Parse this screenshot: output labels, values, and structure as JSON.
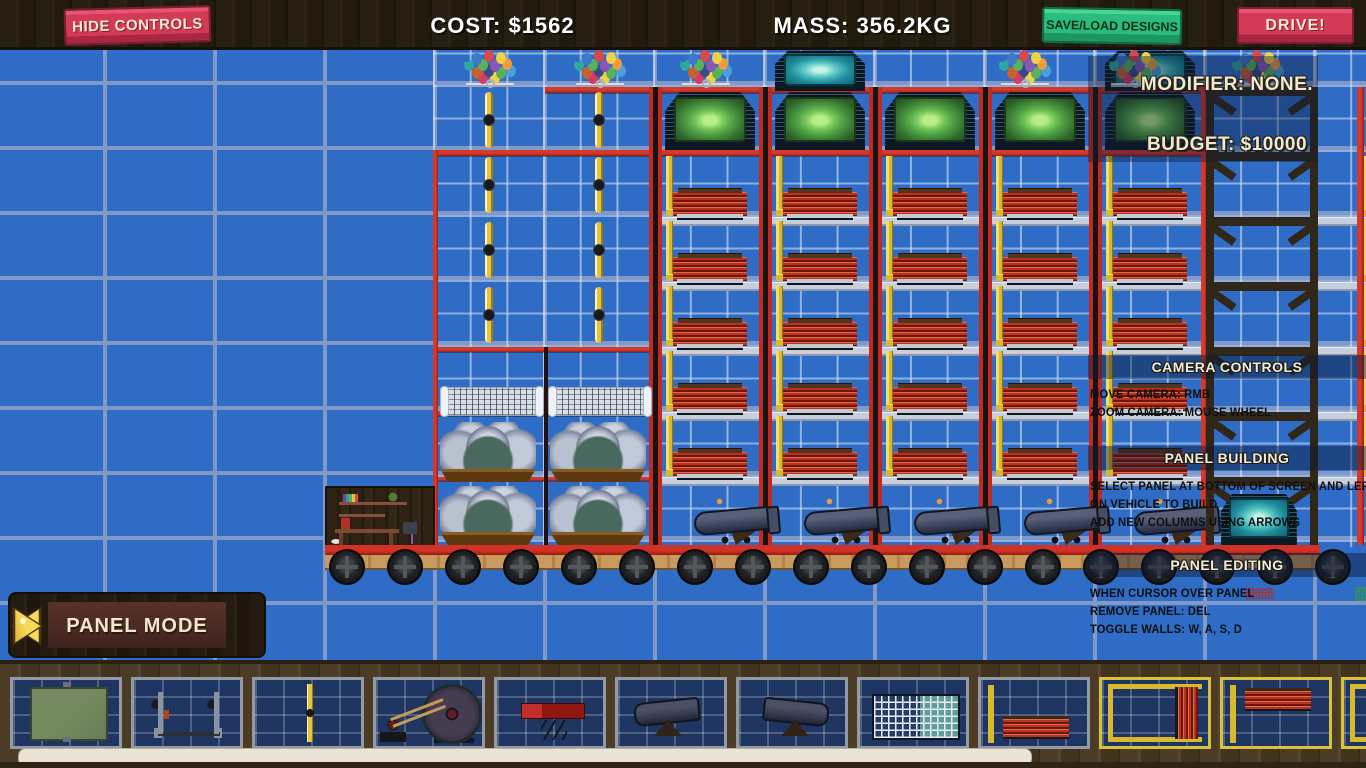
{
  "top_bar": {
    "hide_controls_label": "HIDE CONTROLS",
    "cost_label": "COST: $1562",
    "mass_label": "MASS: 356.2KG",
    "save_load_label": "SAVE/LOAD DESIGNS",
    "drive_label": "DRIVE!"
  },
  "hud": {
    "modifier": "MODIFIER: NONE.",
    "budget": "BUDGET: $10000",
    "camera_controls": {
      "title": "CAMERA CONTROLS",
      "lines": [
        "MOVE CAMERA: RMB",
        "ZOOM CAMERA: MOUSE WHEEL"
      ]
    },
    "panel_building": {
      "title": "PANEL BUILDING",
      "lines": [
        "SELECT PANEL AT BOTTOM OF SCREEN AND LEFT CLICK",
        "ON VEHICLE TO BUILD",
        "ADD NEW COLUMNS USING ARROWS"
      ]
    },
    "panel_editing": {
      "title": "PANEL EDITING",
      "lines": [
        "WHEN CURSOR OVER PANEL",
        "REMOVE PANEL: DEL",
        "TOGGLE WALLS: W, A, S, D"
      ]
    }
  },
  "mode_selector": {
    "label": "PANEL MODE"
  },
  "palette": {
    "items": [
      {
        "id": "green-screen-panel",
        "cls": "it-screen",
        "selected": false
      },
      {
        "id": "tow-hitch",
        "cls": "it-hitch",
        "selected": false
      },
      {
        "id": "propeller",
        "cls": "it-prop",
        "selected": false
      },
      {
        "id": "motor-flywheel",
        "cls": "it-motor",
        "selected": false
      },
      {
        "id": "spring-platform",
        "cls": "it-spring",
        "selected": false
      },
      {
        "id": "cannon-right",
        "cls": "it-cannon",
        "selected": false
      },
      {
        "id": "cannon-left",
        "cls": "it-cannon it-flip",
        "selected": false
      },
      {
        "id": "grid-panel",
        "cls": "it-grid",
        "selected": false
      },
      {
        "id": "radiator-floor",
        "cls": "it-radb",
        "selected": false
      },
      {
        "id": "radiator-right-wall",
        "cls": "it-radr",
        "selected": true
      },
      {
        "id": "radiator-ceiling",
        "cls": "it-radt",
        "selected": true
      },
      {
        "id": "radiator-wall-partial",
        "cls": "it-radr",
        "selected": true
      }
    ]
  },
  "colors": {
    "background_blue": "#2e6cc6",
    "grid_line": "#8099c7",
    "frame_red": "#c5281e",
    "wall_yellow": "#d8b92e",
    "button_red": "#d23a58",
    "button_green": "#2bbd7b",
    "wood_dark": "#281f13",
    "cream_text": "#f3e8cd"
  },
  "scene": {
    "sprites": [
      [
        "finegrid",
        433,
        50,
        933,
        497
      ],
      [
        "gbeam",
        657,
        217,
        548,
        6
      ],
      [
        "gbeam",
        657,
        282,
        548,
        6
      ],
      [
        "gbeam",
        657,
        347,
        548,
        6
      ],
      [
        "gbeam",
        657,
        412,
        548,
        6
      ],
      [
        "gbeam",
        657,
        477,
        548,
        6
      ],
      [
        "gbeam",
        1318,
        217,
        48,
        6
      ],
      [
        "gbeam",
        1318,
        282,
        48,
        6
      ],
      [
        "gbeam",
        1318,
        347,
        48,
        6
      ],
      [
        "gbeam",
        1318,
        412,
        48,
        6
      ],
      [
        "gbeam",
        1318,
        477,
        48,
        6
      ],
      [
        "hline",
        545,
        87,
        660,
        6
      ],
      [
        "hline",
        433,
        150,
        772,
        6
      ],
      [
        "hline",
        433,
        347,
        224,
        5
      ],
      [
        "hline",
        433,
        411,
        224,
        5
      ],
      [
        "hline",
        433,
        477,
        224,
        4
      ],
      [
        "vline",
        433,
        150,
        5,
        400
      ],
      [
        "vline",
        1201,
        87,
        6,
        460
      ],
      [
        "vline",
        1357,
        87,
        7,
        458
      ],
      [
        "vline",
        1313,
        487,
        5,
        60
      ],
      [
        "vdark",
        544,
        347,
        4,
        198
      ],
      [
        "rpost",
        649,
        87,
        13,
        460
      ],
      [
        "rpost",
        759,
        87,
        13,
        460
      ],
      [
        "rpost",
        869,
        87,
        13,
        460
      ],
      [
        "rpost",
        979,
        87,
        13,
        460
      ],
      [
        "rpost",
        1089,
        87,
        13,
        460
      ],
      [
        "ywall",
        666,
        156,
        7,
        58
      ],
      [
        "ywall",
        666,
        221,
        7,
        58
      ],
      [
        "ywall",
        666,
        286,
        7,
        58
      ],
      [
        "ywall",
        666,
        351,
        7,
        58
      ],
      [
        "ywall",
        666,
        416,
        7,
        58
      ],
      [
        "ywall",
        776,
        156,
        7,
        58
      ],
      [
        "ywall",
        776,
        221,
        7,
        58
      ],
      [
        "ywall",
        776,
        286,
        7,
        58
      ],
      [
        "ywall",
        776,
        351,
        7,
        58
      ],
      [
        "ywall",
        776,
        416,
        7,
        58
      ],
      [
        "ywall",
        886,
        156,
        7,
        58
      ],
      [
        "ywall",
        886,
        221,
        7,
        58
      ],
      [
        "ywall",
        886,
        286,
        7,
        58
      ],
      [
        "ywall",
        886,
        351,
        7,
        58
      ],
      [
        "ywall",
        886,
        416,
        7,
        58
      ],
      [
        "ywall",
        996,
        156,
        7,
        58
      ],
      [
        "ywall",
        996,
        221,
        7,
        58
      ],
      [
        "ywall",
        996,
        286,
        7,
        58
      ],
      [
        "ywall",
        996,
        351,
        7,
        58
      ],
      [
        "ywall",
        996,
        416,
        7,
        58
      ],
      [
        "ywall",
        1106,
        156,
        7,
        58
      ],
      [
        "ywall",
        1106,
        221,
        7,
        58
      ],
      [
        "ywall",
        1106,
        286,
        7,
        58
      ],
      [
        "ywall",
        1106,
        351,
        7,
        58
      ],
      [
        "ywall",
        1106,
        416,
        7,
        58
      ],
      [
        "ywall",
        1364,
        156,
        7,
        58
      ],
      [
        "ywall",
        1364,
        221,
        7,
        58
      ],
      [
        "ywall",
        1364,
        286,
        7,
        58
      ],
      [
        "ywall",
        1364,
        351,
        7,
        58
      ],
      [
        "ywall",
        1364,
        416,
        7,
        58
      ],
      [
        "radiator",
        673,
        192,
        74,
        24
      ],
      [
        "radiator",
        673,
        257,
        74,
        24
      ],
      [
        "radiator",
        673,
        322,
        74,
        24
      ],
      [
        "radiator",
        673,
        387,
        74,
        24
      ],
      [
        "radiator",
        673,
        452,
        74,
        24
      ],
      [
        "radiator",
        783,
        192,
        74,
        24
      ],
      [
        "radiator",
        783,
        257,
        74,
        24
      ],
      [
        "radiator",
        783,
        322,
        74,
        24
      ],
      [
        "radiator",
        783,
        387,
        74,
        24
      ],
      [
        "radiator",
        783,
        452,
        74,
        24
      ],
      [
        "radiator",
        893,
        192,
        74,
        24
      ],
      [
        "radiator",
        893,
        257,
        74,
        24
      ],
      [
        "radiator",
        893,
        322,
        74,
        24
      ],
      [
        "radiator",
        893,
        387,
        74,
        24
      ],
      [
        "radiator",
        893,
        452,
        74,
        24
      ],
      [
        "radiator",
        1003,
        192,
        74,
        24
      ],
      [
        "radiator",
        1003,
        257,
        74,
        24
      ],
      [
        "radiator",
        1003,
        322,
        74,
        24
      ],
      [
        "radiator",
        1003,
        387,
        74,
        24
      ],
      [
        "radiator",
        1003,
        452,
        74,
        24
      ],
      [
        "radiator",
        1113,
        192,
        74,
        24
      ],
      [
        "radiator",
        1113,
        257,
        74,
        24
      ],
      [
        "radiator",
        1113,
        322,
        74,
        24
      ],
      [
        "radiator",
        1113,
        387,
        74,
        24
      ],
      [
        "radiator",
        1113,
        452,
        74,
        24
      ],
      [
        "gscreen",
        659,
        91,
        102,
        59
      ],
      [
        "gscreen",
        769,
        91,
        102,
        59
      ],
      [
        "gscreen",
        879,
        91,
        102,
        59
      ],
      [
        "gscreen",
        989,
        91,
        102,
        59
      ],
      [
        "gscreen",
        1099,
        91,
        102,
        59
      ],
      [
        "tscreen",
        770,
        50,
        100,
        41
      ],
      [
        "tscreen",
        1100,
        50,
        100,
        41
      ],
      [
        "prop",
        485,
        92,
        8,
        56
      ],
      [
        "prop",
        485,
        157,
        8,
        56
      ],
      [
        "prop",
        485,
        222,
        8,
        56
      ],
      [
        "prop",
        485,
        287,
        8,
        56
      ],
      [
        "prop",
        595,
        92,
        8,
        56
      ],
      [
        "prop",
        595,
        157,
        8,
        56
      ],
      [
        "prop",
        595,
        222,
        8,
        56
      ],
      [
        "prop",
        595,
        287,
        8,
        56
      ],
      [
        "net",
        441,
        387,
        100,
        27
      ],
      [
        "net",
        549,
        387,
        100,
        27
      ],
      [
        "boulders",
        436,
        422,
        104,
        60
      ],
      [
        "boulders",
        546,
        422,
        104,
        60
      ],
      [
        "boulders",
        436,
        486,
        104,
        59
      ],
      [
        "boulders",
        546,
        486,
        104,
        59
      ],
      [
        "room",
        325,
        486,
        110,
        61
      ],
      [
        "baseline",
        325,
        545,
        995,
        10
      ],
      [
        "basewood",
        325,
        555,
        995,
        13
      ],
      [
        "wheel",
        329,
        549,
        32,
        32
      ],
      [
        "wheel",
        387,
        549,
        32,
        32
      ],
      [
        "wheel",
        445,
        549,
        32,
        32
      ],
      [
        "wheel",
        503,
        549,
        32,
        32
      ],
      [
        "wheel",
        561,
        549,
        32,
        32
      ],
      [
        "wheel",
        619,
        549,
        32,
        32
      ],
      [
        "wheel",
        677,
        549,
        32,
        32
      ],
      [
        "wheel",
        735,
        549,
        32,
        32
      ],
      [
        "wheel",
        793,
        549,
        32,
        32
      ],
      [
        "wheel",
        851,
        549,
        32,
        32
      ],
      [
        "wheel",
        909,
        549,
        32,
        32
      ],
      [
        "wheel",
        967,
        549,
        32,
        32
      ],
      [
        "wheel",
        1025,
        549,
        32,
        32
      ],
      [
        "wheel",
        1083,
        549,
        32,
        32
      ],
      [
        "wheel",
        1141,
        549,
        32,
        32
      ],
      [
        "wheel",
        1199,
        549,
        32,
        32
      ],
      [
        "wheel",
        1257,
        549,
        32,
        32
      ],
      [
        "wheel",
        1315,
        549,
        32,
        32
      ],
      [
        "cannon",
        690,
        497,
        92,
        49
      ],
      [
        "cannon",
        800,
        497,
        92,
        49
      ],
      [
        "cannon",
        910,
        497,
        92,
        49
      ],
      [
        "cannon",
        1020,
        497,
        92,
        49
      ],
      [
        "cannon",
        1130,
        497,
        92,
        49
      ],
      [
        "woodcell",
        1206,
        87,
        112,
        65
      ],
      [
        "woodcell",
        1206,
        152,
        112,
        65
      ],
      [
        "woodcell",
        1206,
        217,
        112,
        65
      ],
      [
        "woodcell",
        1206,
        282,
        112,
        65
      ],
      [
        "woodcell",
        1206,
        347,
        112,
        65
      ],
      [
        "woodcell",
        1206,
        412,
        112,
        65
      ],
      [
        "woodcell",
        1206,
        477,
        112,
        68
      ],
      [
        "tscreen",
        1217,
        493,
        84,
        52
      ],
      [
        "stand",
        466,
        83,
        48,
        4
      ],
      [
        "stand",
        576,
        83,
        48,
        4
      ],
      [
        "stand",
        682,
        83,
        48,
        4
      ],
      [
        "stand",
        1001,
        83,
        48,
        4
      ],
      [
        "stand",
        1111,
        83,
        48,
        4
      ],
      [
        "stand",
        1234,
        83,
        48,
        4
      ],
      [
        "balloons",
        462,
        50,
        56,
        36
      ],
      [
        "balloons",
        572,
        50,
        56,
        36
      ],
      [
        "balloons",
        678,
        50,
        56,
        36
      ],
      [
        "balloons",
        997,
        50,
        56,
        36
      ],
      [
        "balloons",
        1107,
        50,
        56,
        36
      ],
      [
        "balloons",
        1230,
        50,
        56,
        36
      ],
      [
        "shade",
        1088,
        56,
        230,
        106
      ],
      [
        "dotsred",
        1246,
        588,
        28,
        11
      ],
      [
        "dotsgreen",
        1355,
        587,
        11,
        14
      ]
    ]
  }
}
